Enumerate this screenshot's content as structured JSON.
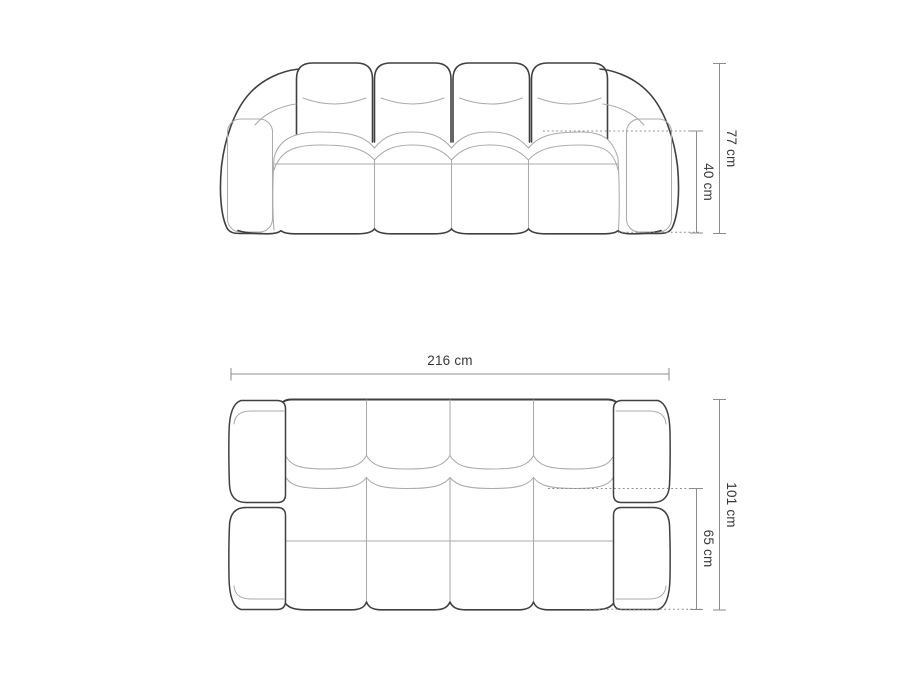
{
  "drawing": {
    "subject": "sofa",
    "views": {
      "front": {
        "dimensions": {
          "total_height": {
            "label": "77 cm",
            "value": 77,
            "unit": "cm"
          },
          "seat_height": {
            "label": "40 cm",
            "value": 40,
            "unit": "cm"
          }
        }
      },
      "top": {
        "dimensions": {
          "total_width": {
            "label": "216 cm",
            "value": 216,
            "unit": "cm"
          },
          "total_depth": {
            "label": "101 cm",
            "value": 101,
            "unit": "cm"
          },
          "seat_depth": {
            "label": "65 cm",
            "value": 65,
            "unit": "cm"
          }
        }
      }
    }
  },
  "colors": {
    "background": "#ffffff",
    "outline": "#404040",
    "inner_line": "#ababab",
    "dimension_line": "#8c8c8c",
    "label_text": "#383838"
  }
}
